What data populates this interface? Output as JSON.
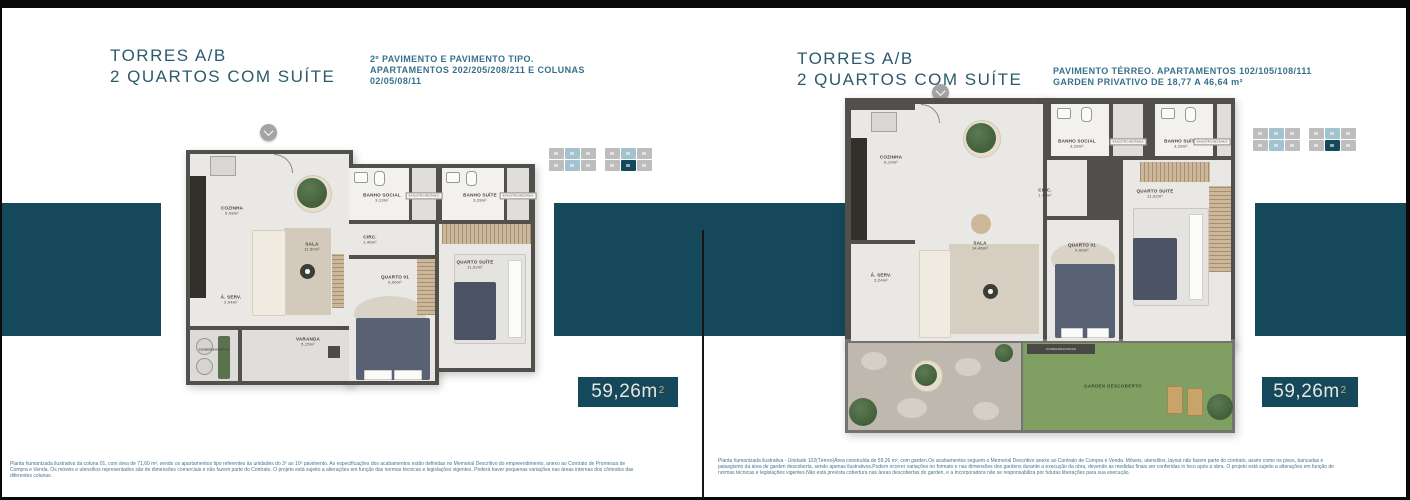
{
  "colors": {
    "frame": "#0a0a0a",
    "accent_teal": "#14485a",
    "title": "#2c5a6d",
    "subtitle": "#36718b",
    "badge_text": "#e9e6df",
    "badge_sup": "#cfa878",
    "keyplan_gray": "#bdbdbd",
    "keyplan_blue": "#a3c2cf",
    "keyplan_teal": "#14485a"
  },
  "header_left": {
    "title_line1": "TORRES A/B",
    "title_line2": "2 QUARTOS COM SUÍTE",
    "subtitle_lines": [
      "2º PAVIMENTO  E PAVIMENTO TIPO.",
      "APARTAMENTOS 202/205/208/211 E COLUNAS",
      "02/05/08/11"
    ]
  },
  "header_right": {
    "title_line1": "TORRES A/B",
    "title_line2": "2 QUARTOS COM SUÍTE",
    "subtitle_lines": [
      "PAVIMENTO TÉRREO. APARTAMENTOS 102/105/108/111",
      "GARDEN PRIVATIVO DE 18,77 A 46,64 m²"
    ]
  },
  "badge_left": {
    "value": "59,26m",
    "sup": "2"
  },
  "badge_right": {
    "value": "59,26m",
    "sup": "2"
  },
  "plan_left": {
    "rooms": {
      "cozinha": {
        "name": "COZINHA",
        "area": "5,08m²"
      },
      "sala": {
        "name": "SALA",
        "area": "11,50m²"
      },
      "aserv": {
        "name": "Á. SERV.",
        "area": "2,04m²"
      },
      "varanda": {
        "name": "VARANDA",
        "area": "5,15m²"
      },
      "condensadoras": {
        "name": "CONDENSADORAS"
      },
      "banho_social": {
        "name": "BANHO SOCIAL",
        "area": "3,13m²"
      },
      "banho_suite": {
        "name": "BANHO SUÍTE",
        "area": "3,28m²"
      },
      "circ": {
        "name": "CIRC.",
        "area": "1,46m²"
      },
      "quarto01": {
        "name": "QUARTO 01",
        "area": "9,06m²"
      },
      "quarto_suite": {
        "name": "QUARTO SUÍTE",
        "area": "11,02m²"
      }
    },
    "exaustao": "EXAUSTÃO MECÂNICA"
  },
  "plan_right": {
    "rooms": {
      "cozinha": {
        "name": "COZINHA",
        "area": "6,10m²"
      },
      "sala": {
        "name": "SALA",
        "area": "14,46m²"
      },
      "aserv": {
        "name": "Á. SERV.",
        "area": "3,24m²"
      },
      "condensadoras": {
        "name": "CONDENSADORAS"
      },
      "banho_social": {
        "name": "BANHO SOCIAL",
        "area": "3,28m²"
      },
      "banho_suite": {
        "name": "BANHO SUÍTE",
        "area": "3,28m²"
      },
      "circ": {
        "name": "CIRC.",
        "area": "1,46m²"
      },
      "quarto01": {
        "name": "QUARTO 01",
        "area": "9,06m²"
      },
      "quarto_suite": {
        "name": "QUARTO SUITE",
        "area": "11,02m²"
      },
      "garden": {
        "name": "GARDEN DESCOBERTO"
      }
    },
    "exaustao": "EXAUSTÃO MECÂNICA"
  },
  "keyplan": {
    "colors": {
      "g": "#bdbdbd",
      "b": "#a3c2cf",
      "t": "#14485a"
    },
    "left": {
      "rows": [
        [
          "g",
          "b",
          "g",
          "-",
          "g",
          "b",
          "g"
        ],
        [
          "g",
          "b",
          "g",
          "-",
          "g",
          "t",
          "g"
        ]
      ]
    },
    "right": {
      "rows": [
        [
          "g",
          "b",
          "g",
          "-",
          "g",
          "b",
          "g"
        ],
        [
          "g",
          "b",
          "g",
          "-",
          "g",
          "t",
          "g"
        ]
      ]
    }
  },
  "disclaimer_left": {
    "lines": [
      "Planta humanizada ilustrativa da coluna 01, com área de 71,60 m², sendo os apartamentos tipo referentes às unidades do 3º ao 10º pavimento. As especificações dos acabamentos estão definidas no Memorial Descritivo do empreendimento, anexo ao Contrato de Promessa de",
      "Compra e Venda. Os móveis e utensílios representados são de dimensões comerciais e não fazem parte do Contrato. O projeto está sujeito a alterações em função das normas técnicas e legislações vigentes. Poderá haver pequenas variações nas áreas internas dos cômodos das",
      "diferentes colunas."
    ]
  },
  "disclaimer_right": {
    "lines": [
      "Planta humanizada ilustrativa - Unidade 102(Térreo)Área construída de 59,26 m², com garden.Os acabamentos seguem o Memorial Descritivo anexo ao Contrato de Compra e Venda. Móveis, utensílios, layout não fazem parte do contrato, assim como os pisos, bancadas e",
      "paisagismo da área de garden descoberta, sendo apenas ilustrativos.Podem ocorrer variações no formato e nas dimensões dos gardens durante a execução da obra, devendo as medidas finais ser conferidas in loco após a obra. O projeto está sujeito a alterações em função de",
      "normas técnicas e legislações vigentes.Não está prevista cobertura nas áreas descobertas do garden, e a Incorporadora não se responsabiliza por futuras liberações para sua execução."
    ]
  }
}
